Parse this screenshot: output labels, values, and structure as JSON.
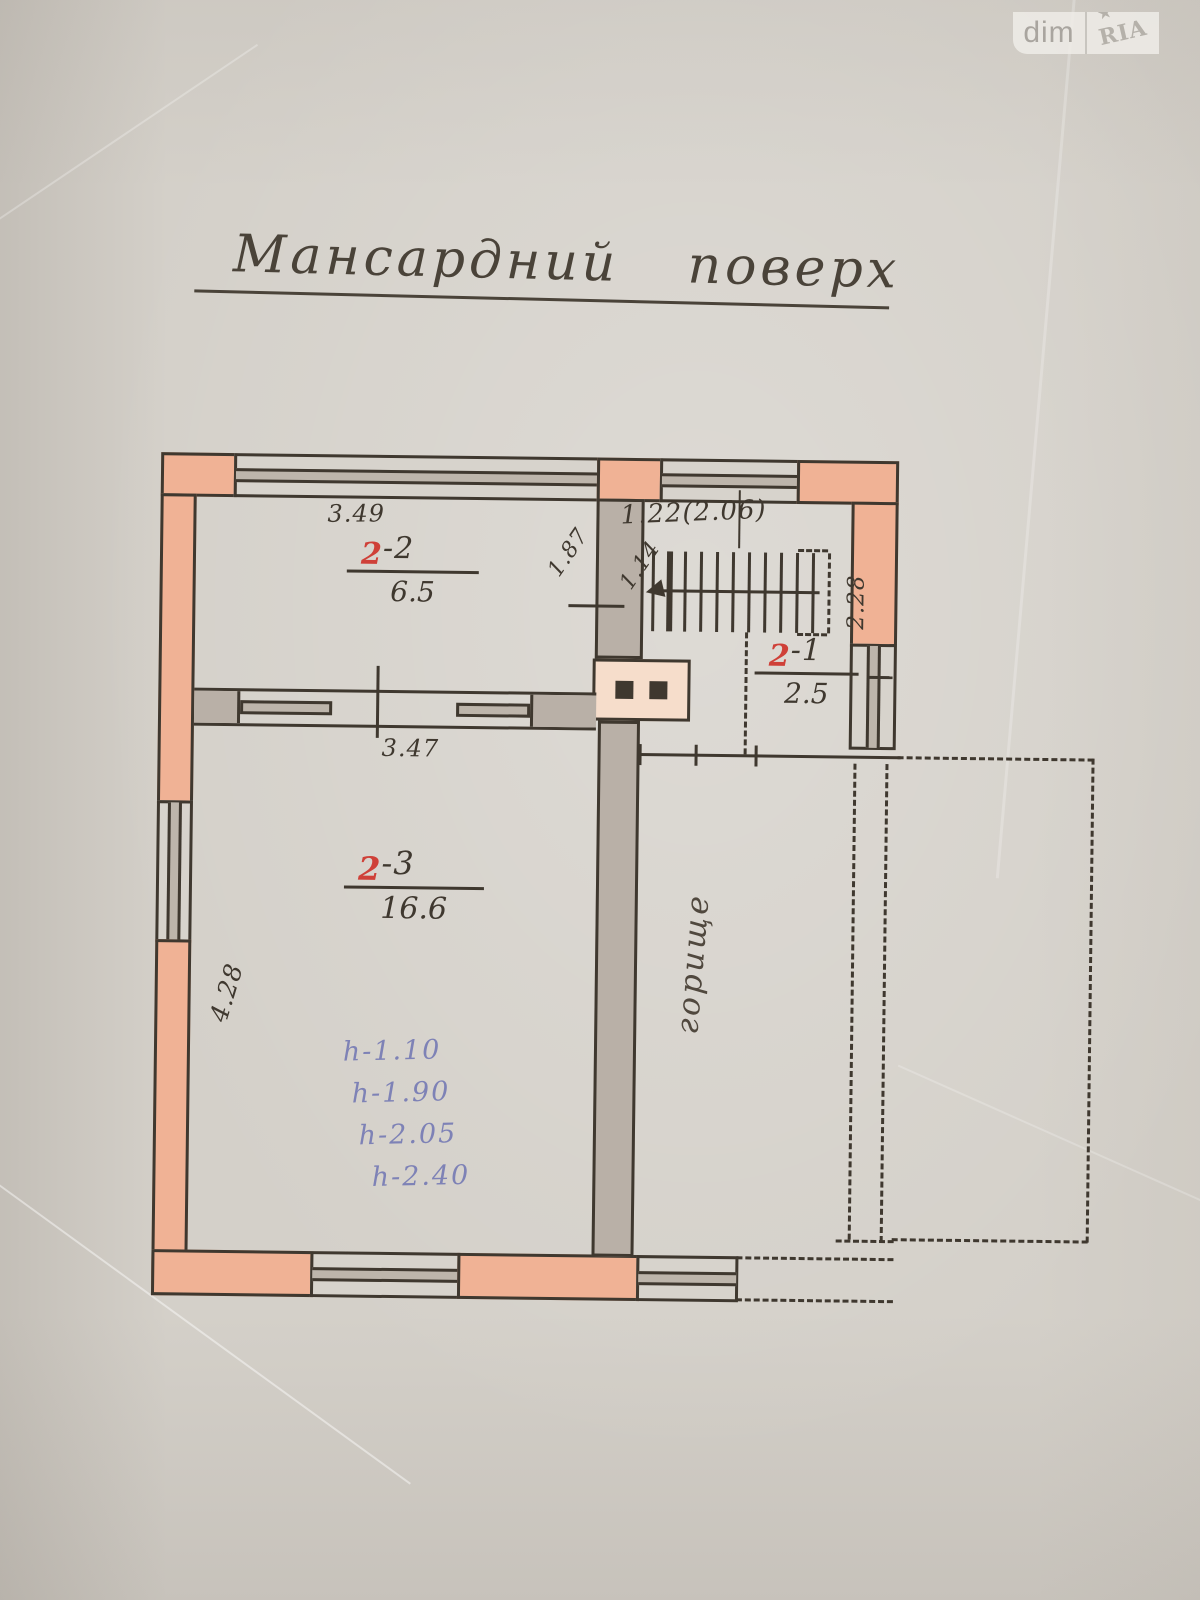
{
  "watermark": {
    "left_text": "dim",
    "right_text": "RIA",
    "star": "★"
  },
  "title": "Мансардний поверх",
  "rooms": {
    "r22": {
      "num": "2",
      "suffix": "-2",
      "area": "6.5"
    },
    "r21": {
      "num": "2",
      "suffix": "-1",
      "area": "2.5"
    },
    "r23": {
      "num": "2",
      "suffix": "-3",
      "area": "16.6"
    }
  },
  "dimensions": {
    "d349": "3.49",
    "d347": "3.47",
    "d122": "1.22(2.06)",
    "d187": "1.87",
    "d114": "1.14",
    "d228": "2.28",
    "d428": "4.28"
  },
  "attic_label": "горище",
  "heights": [
    "h-1.10",
    "h-1.90",
    "h-2.05",
    "h-2.40"
  ],
  "colors": {
    "paper": "#d4d0c9",
    "ink": "#3f382f",
    "wall_fill": "#f0b295",
    "wall_gray": "#b9b0a7",
    "chimney_fill": "#f6ddcb",
    "room_number_red": "#cf4038",
    "height_notes_blue": "#7e82b6"
  }
}
